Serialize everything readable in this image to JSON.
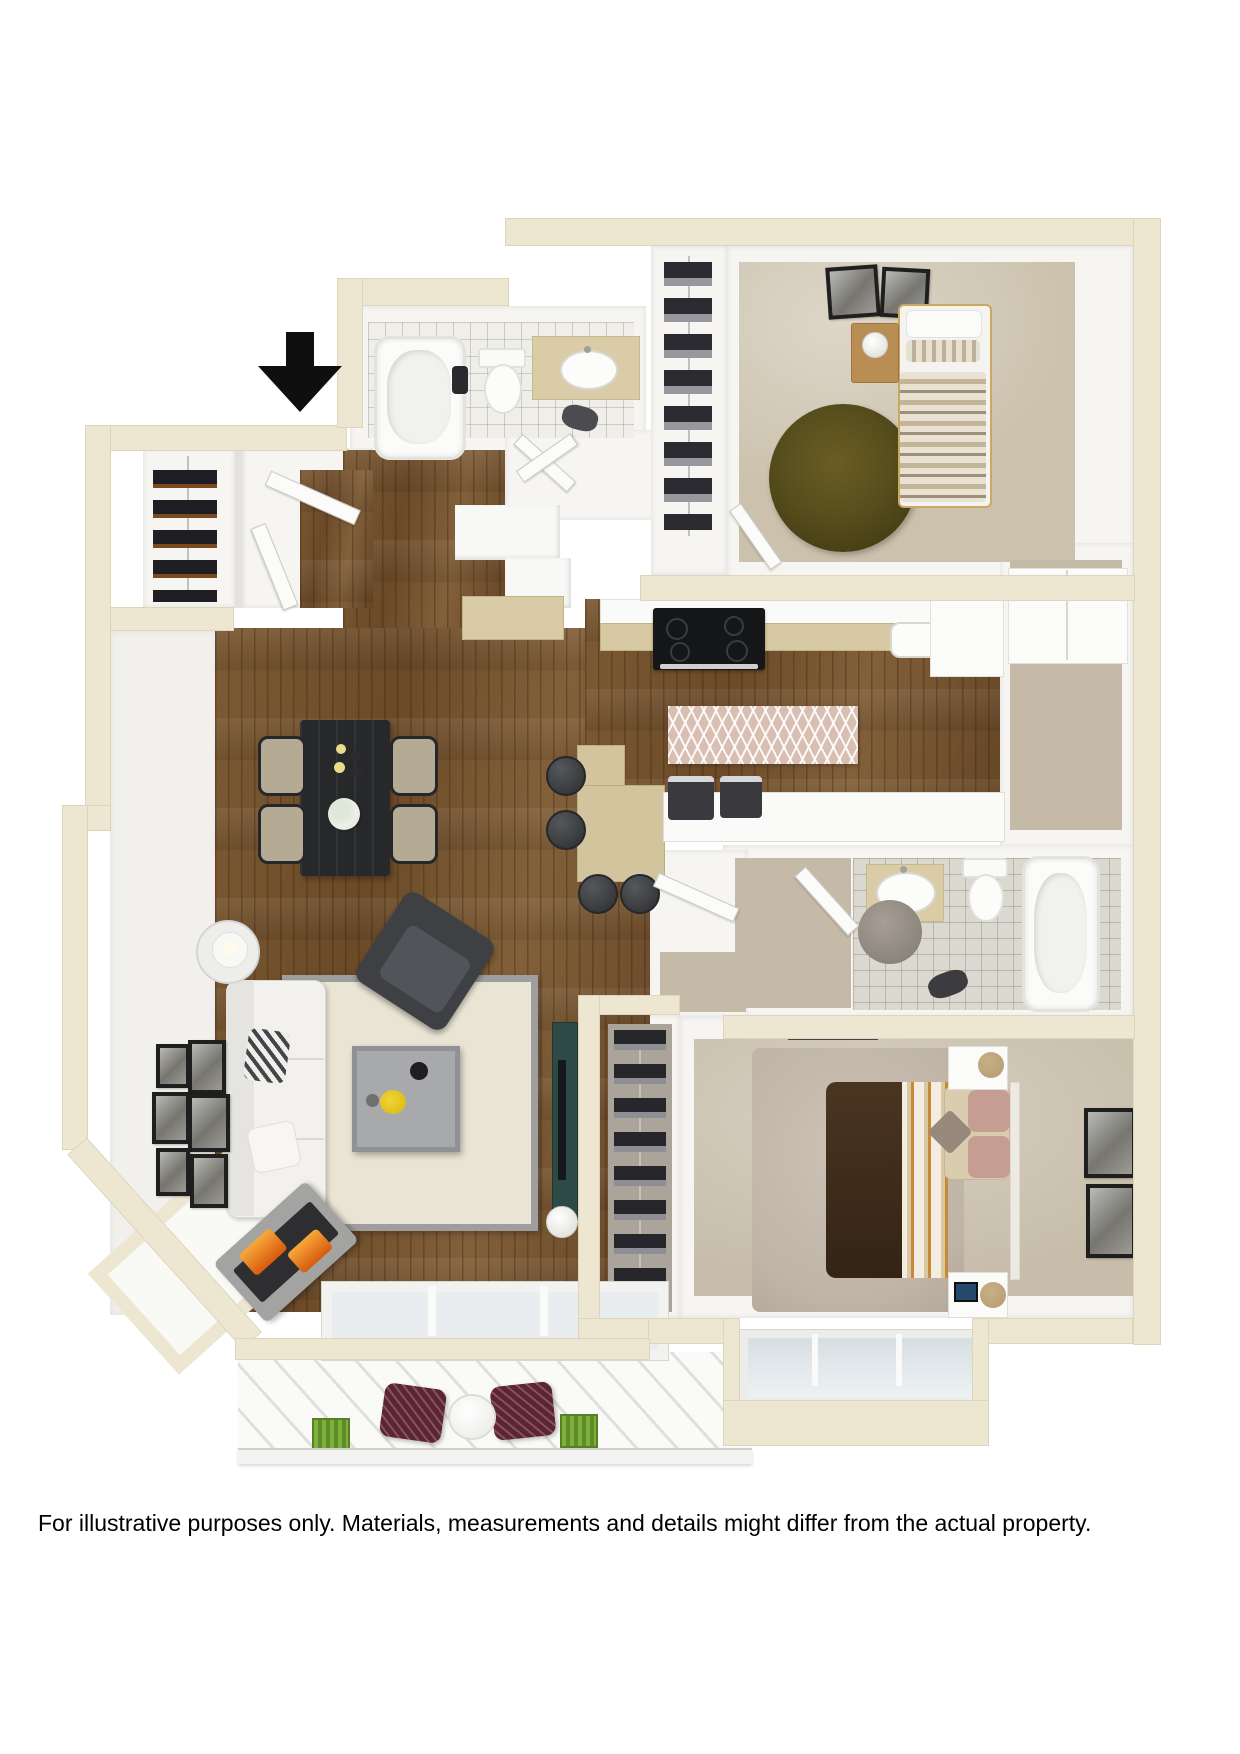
{
  "disclaimer": {
    "text": "For illustrative purposes only.  Materials, measurements and details might differ from the actual property."
  },
  "floor_plan": {
    "description": "3D top-down rendering of a two-bedroom, two-bathroom apartment floor plan with balcony",
    "entry_indicator": "black-down-arrow",
    "colors": {
      "outer_wall": "#EDE6D1",
      "interior_wall": "#F1F0ED",
      "wood_floor": "#75522E",
      "bedroom_carpet": "#CBC1AC",
      "hall_carpet": "#C4BAA7",
      "bath_tile_white": "#EFEEE9",
      "bath_tile_gray": "#DBD8D0",
      "olive_round_rug": "#574E1D",
      "living_rug": "#EAE4D4",
      "living_rug_border": "#9E9E9E",
      "master_duvet_brown": "#46321F",
      "stripe_accent_orange": "#C8893B",
      "patio_chair_burgundy": "#5D2433",
      "planter_green": "#6FA032",
      "fireplace_flame": "#E26A12",
      "dining_table_black": "#27282A"
    },
    "rooms": [
      {
        "name": "entry",
        "features": [
          "entry-doors",
          "coat-closet-wine-rack"
        ]
      },
      {
        "name": "bathroom-1",
        "features": [
          "bathtub",
          "toilet",
          "vanity-sink",
          "bath-mat",
          "towel"
        ]
      },
      {
        "name": "bedroom-2",
        "features": [
          "twin-bed",
          "nightstand-lamp",
          "round-olive-rug",
          "closet-clothes",
          "wall-art"
        ]
      },
      {
        "name": "kitchen",
        "features": [
          "range-stove",
          "kitchen-sink",
          "upper-cabinets",
          "chevron-runner-rug",
          "breakfast-bar",
          "bar-stools",
          "countertop-appliances"
        ]
      },
      {
        "name": "dining-area",
        "features": [
          "dining-table",
          "four-chairs",
          "flower-vase",
          "candles"
        ]
      },
      {
        "name": "living-room",
        "features": [
          "sofa",
          "throw-pillows",
          "armchair",
          "coffee-table",
          "area-rug",
          "fireplace",
          "tv-console",
          "side-table-lamp",
          "gallery-wall"
        ]
      },
      {
        "name": "hallway",
        "features": [
          "linen-closet"
        ]
      },
      {
        "name": "bathroom-2",
        "features": [
          "vanity-sink",
          "toilet",
          "bathtub",
          "round-rug",
          "clothes-on-floor"
        ]
      },
      {
        "name": "walk-in-closet",
        "features": [
          "shoe-shelves"
        ]
      },
      {
        "name": "master-bedroom",
        "features": [
          "queen-bed",
          "two-nightstands",
          "shag-rug",
          "wall-art",
          "window-bay"
        ]
      },
      {
        "name": "balcony",
        "features": [
          "two-patio-chairs",
          "round-side-table",
          "planter-boxes",
          "railing",
          "sliding-door"
        ]
      }
    ]
  }
}
